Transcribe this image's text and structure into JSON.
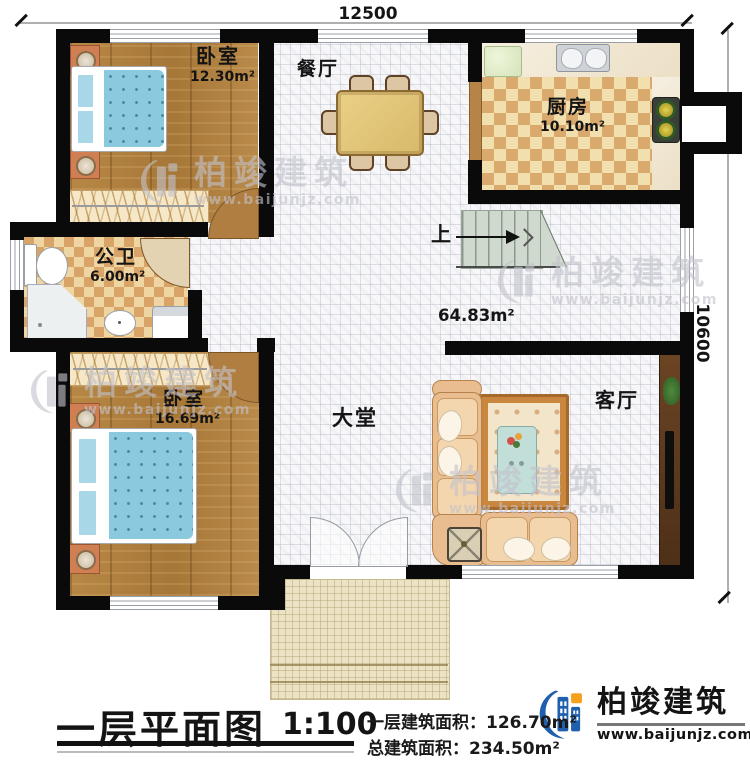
{
  "dimensions": {
    "width_label": "12500",
    "height_label": "10600"
  },
  "rooms": {
    "bedroom_top": {
      "name": "卧室",
      "area": "12.30m²"
    },
    "dining": {
      "name": "餐厅"
    },
    "kitchen": {
      "name": "厨房",
      "area": "10.10m²"
    },
    "bathroom": {
      "name": "公卫",
      "area": "6.00m²"
    },
    "bedroom_bottom": {
      "name": "卧室",
      "area": "16.69m²"
    },
    "hall": {
      "name": "大堂",
      "area": "64.83m²"
    },
    "living": {
      "name": "客厅"
    },
    "stairs": {
      "up_label": "上"
    }
  },
  "title_block": {
    "title": "一层平面图",
    "scale": "1:100",
    "floor_area_label": "一层建筑面积：",
    "floor_area_value": "126.70m²",
    "total_area_label": "总建筑面积：",
    "total_area_value": "234.50m²"
  },
  "brand": {
    "name": "柏竣建筑",
    "website": "www.baijunjz.com"
  },
  "watermark": {
    "name": "柏竣建筑",
    "website": "www.baijunjz.com"
  },
  "colors": {
    "wall": "#0a0a0a",
    "brand_blue": "#1f5fae",
    "brand_orange": "#f5a11c",
    "wood": "#b0803f",
    "tile": "#f7f7f9",
    "checker_light": "#f1dfae",
    "checker_dark": "#d9a96e"
  }
}
